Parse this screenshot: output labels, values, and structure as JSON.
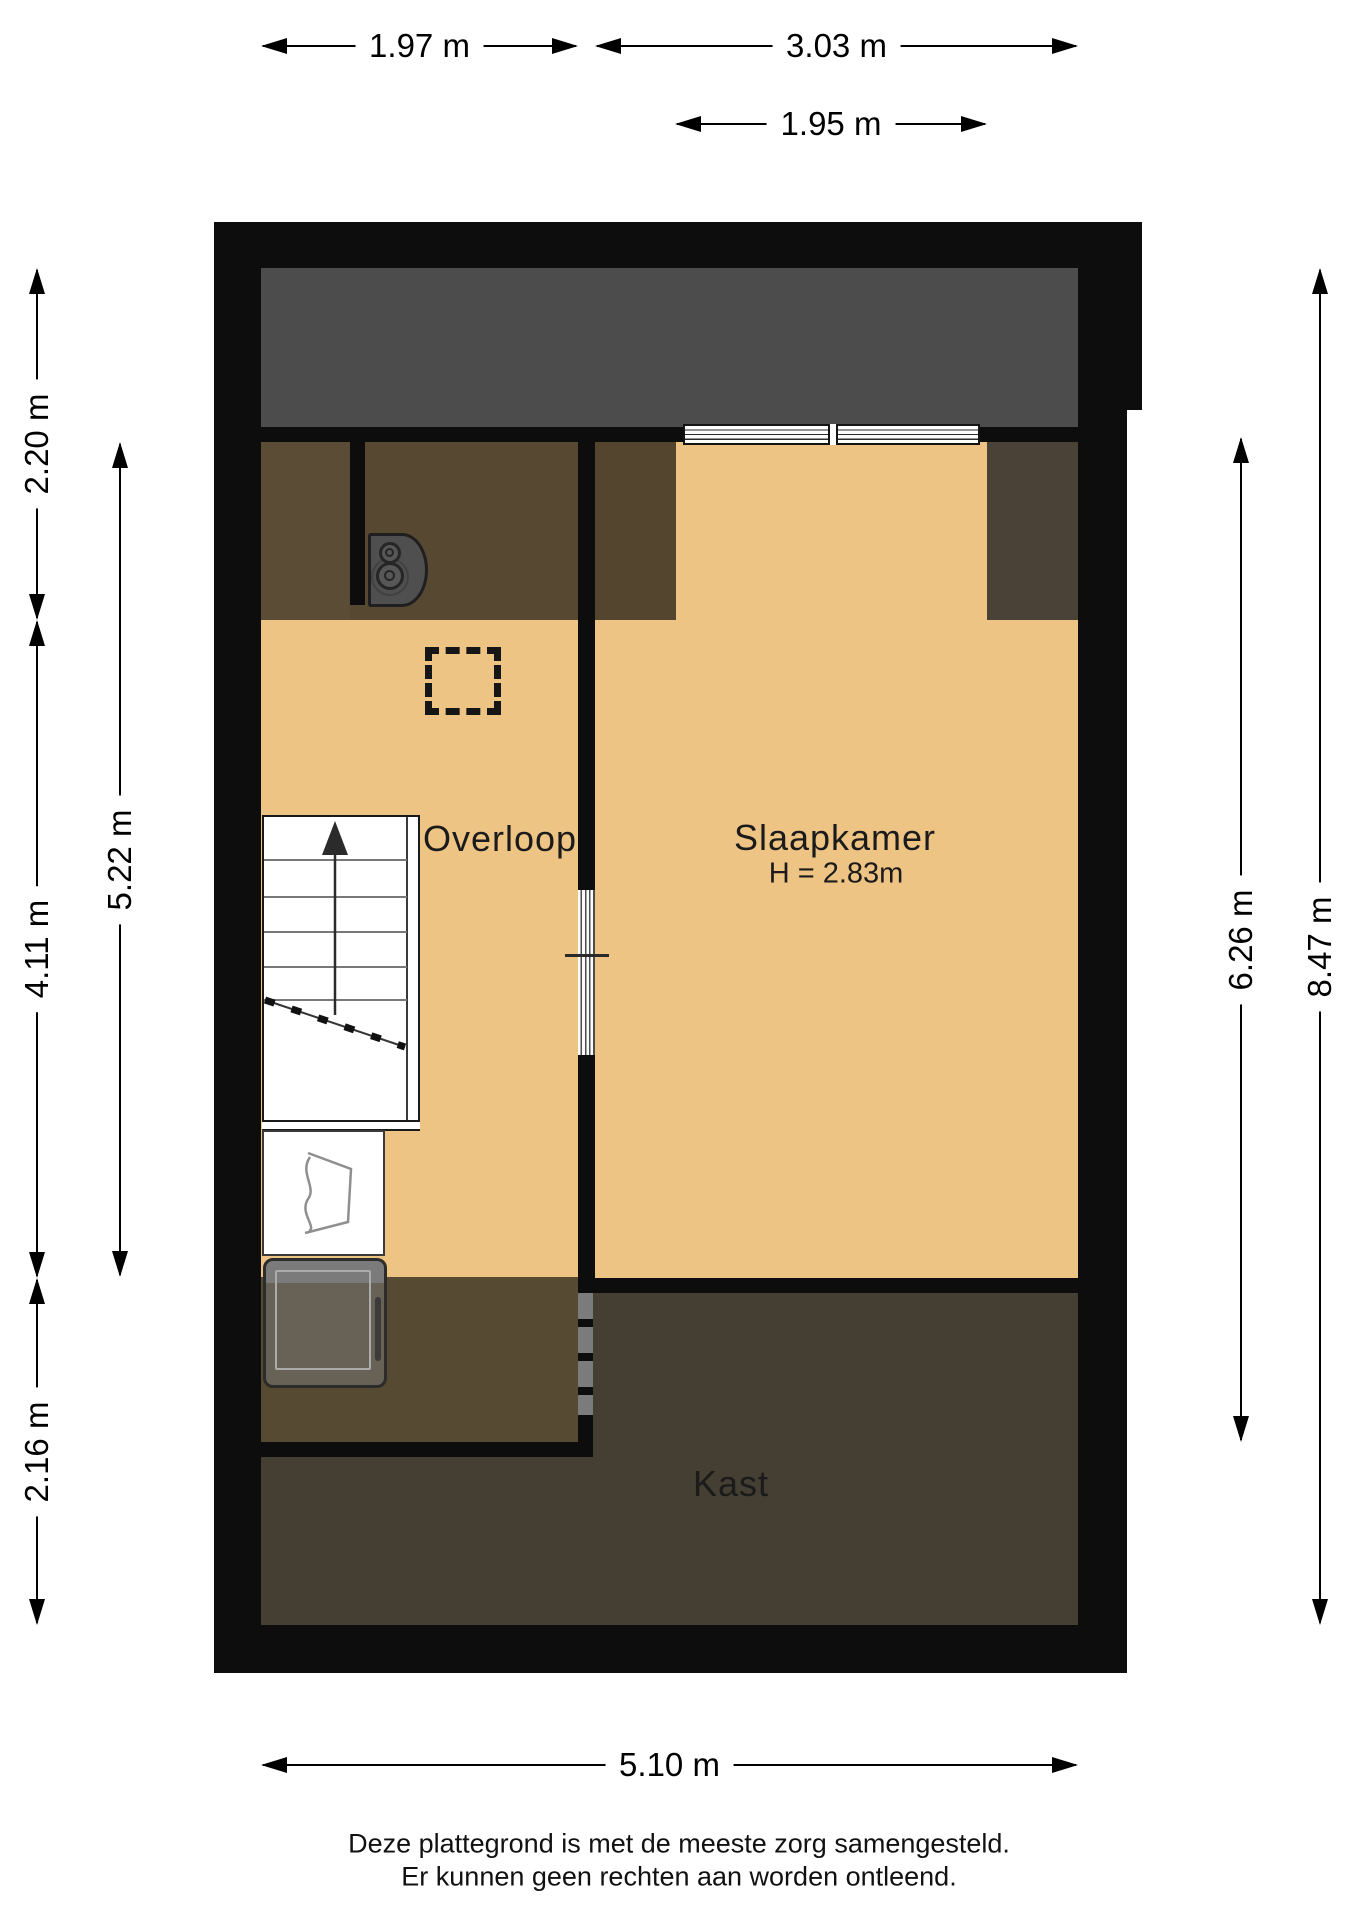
{
  "rooms": {
    "overloop": {
      "label": "Overloop"
    },
    "slaapkamer": {
      "label": "Slaapkamer",
      "height_note": "H = 2.83m"
    },
    "kast": {
      "label": "Kast"
    }
  },
  "dimensions": {
    "top": [
      {
        "label": "1.97 m"
      },
      {
        "label": "3.03 m"
      },
      {
        "label": "1.95 m"
      }
    ],
    "left": [
      {
        "label": "2.20 m"
      },
      {
        "label": "4.11 m"
      },
      {
        "label": "2.16 m"
      },
      {
        "label": "5.22 m"
      }
    ],
    "right": [
      {
        "label": "6.26 m"
      },
      {
        "label": "8.47 m"
      }
    ],
    "bottom": [
      {
        "label": "5.10 m"
      }
    ]
  },
  "footer": {
    "line1": "Deze plattegrond is met de meeste zorg samengesteld.",
    "line2": "Er kunnen geen rechten aan worden ontleend."
  },
  "colors": {
    "wall": "#0d0d0d",
    "roof_void": "#4c4c4c",
    "floor_tan": "#eec485",
    "attic_brown_1": "#5b4c36",
    "attic_brown_2": "#564831",
    "attic_brown_3": "#53452e",
    "attic_brown_4": "#4a4237",
    "storage_brown": "#574a33",
    "kast_floor": "#453e32",
    "white": "#ffffff"
  }
}
